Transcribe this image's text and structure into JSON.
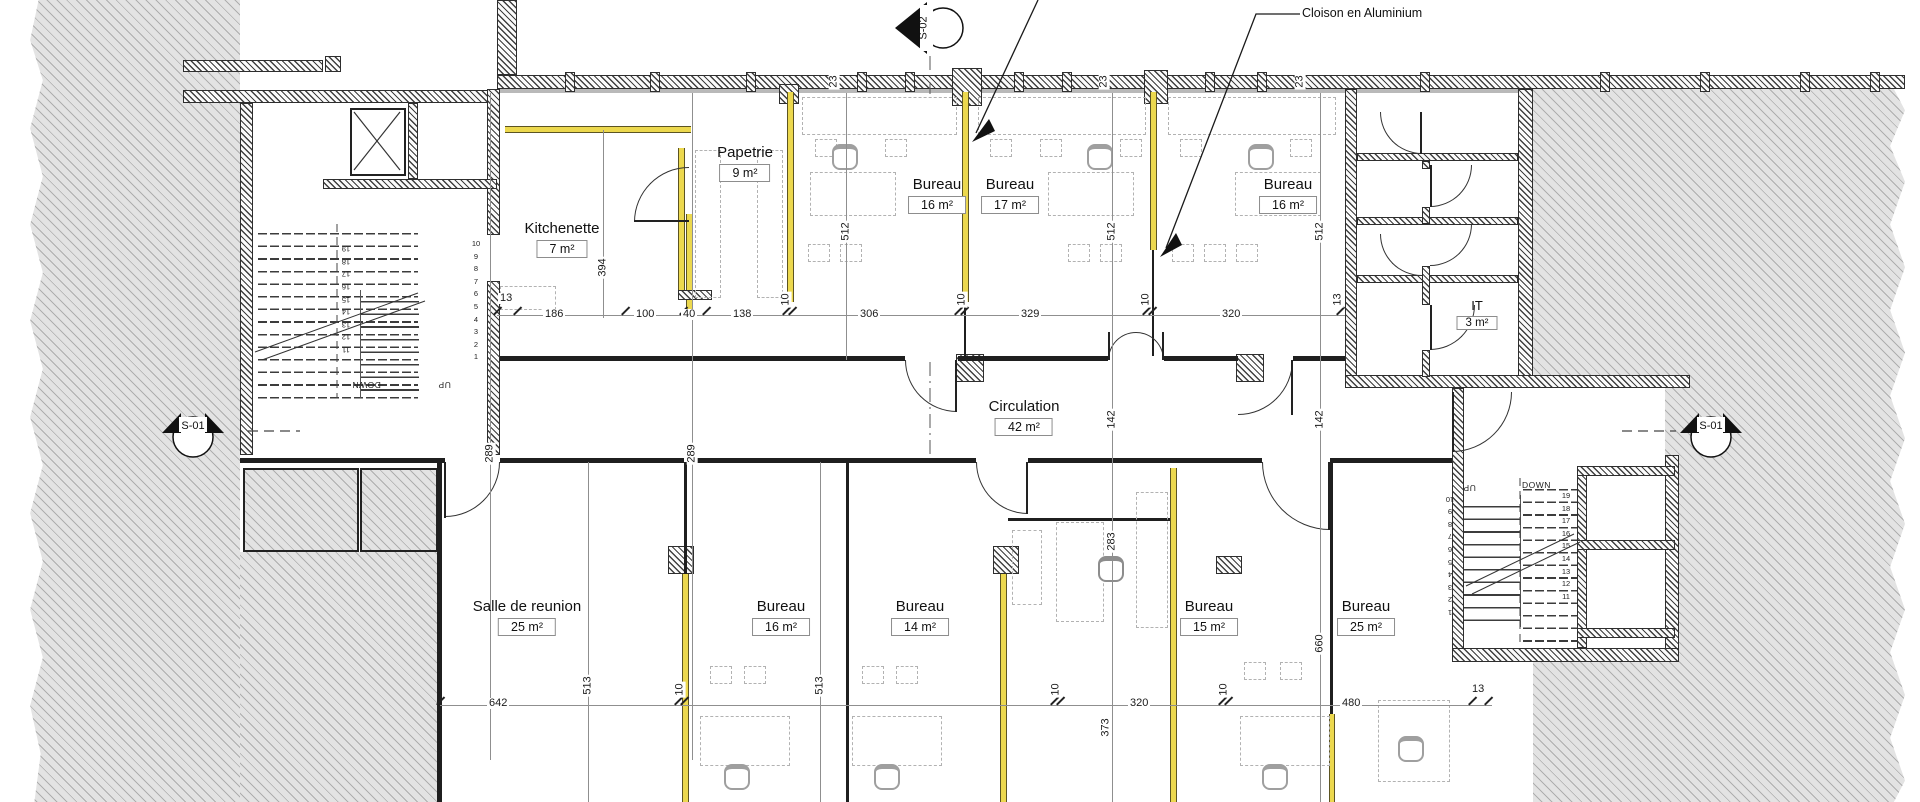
{
  "annotation": {
    "label": "Cloison en Aluminium"
  },
  "markers": {
    "s02": "S-02",
    "s01_left": "S-01",
    "s01_right": "S-01"
  },
  "rooms": {
    "papetrie": {
      "name": "Papetrie",
      "area": "9 m²"
    },
    "kitchenette": {
      "name": "Kitchenette",
      "area": "7 m²"
    },
    "bureau_t1": {
      "name": "Bureau",
      "area": "16 m²"
    },
    "bureau_t2": {
      "name": "Bureau",
      "area": "17 m²"
    },
    "bureau_t3": {
      "name": "Bureau",
      "area": "16 m²"
    },
    "it": {
      "name": "IT",
      "area": "3 m²"
    },
    "circulation": {
      "name": "Circulation",
      "area": "42 m²"
    },
    "salle": {
      "name": "Salle de reunion",
      "area": "25 m²"
    },
    "bureau_b1": {
      "name": "Bureau",
      "area": "16 m²"
    },
    "bureau_b2": {
      "name": "Bureau",
      "area": "14 m²"
    },
    "bureau_b3": {
      "name": "Bureau",
      "area": "15 m²"
    },
    "bureau_b4": {
      "name": "Bureau",
      "area": "25 m²"
    }
  },
  "dims": {
    "top": {
      "w13": "13",
      "w186": "186",
      "w100": "100",
      "w40": "40",
      "w138": "138",
      "p10a": "10",
      "w306": "306",
      "p10b": "10",
      "w329": "329",
      "p10c": "10",
      "w320": "320"
    },
    "wall23": {
      "a": "23",
      "b": "23",
      "c": "23"
    },
    "vert": {
      "v394": "394",
      "v512a": "512",
      "v512b": "512",
      "v512c": "512",
      "v289a": "289",
      "v289b": "289",
      "v142a": "142",
      "v142b": "142",
      "v283": "283",
      "v373": "373",
      "v660": "660",
      "v513a": "513",
      "v513b": "513",
      "wc13": "13"
    },
    "bottom": {
      "w642": "642",
      "p10a": "10",
      "p10b": "10",
      "p10c": "10",
      "w320": "320",
      "w480": "480",
      "w13": "13"
    }
  },
  "stairs": {
    "left": {
      "down": "DOWN",
      "up": "UP",
      "nums_a": "10\n9\n8\n7\n6\n5\n4\n3\n2\n1",
      "nums_b": "11\n12\n13\n14\n15\n16\n17\n18\n19"
    },
    "right": {
      "down": "DOWN",
      "up": "UP",
      "nums_a": "19\n18\n17\n16\n15\n14\n13\n12\n11",
      "nums_b": "1\n2\n3\n4\n5\n6\n7\n8\n9\n10"
    }
  },
  "colors": {
    "partition_yellow": "#ecd84e",
    "poche_gray": "#e3e3e3",
    "line_black": "#1f1f1f"
  }
}
